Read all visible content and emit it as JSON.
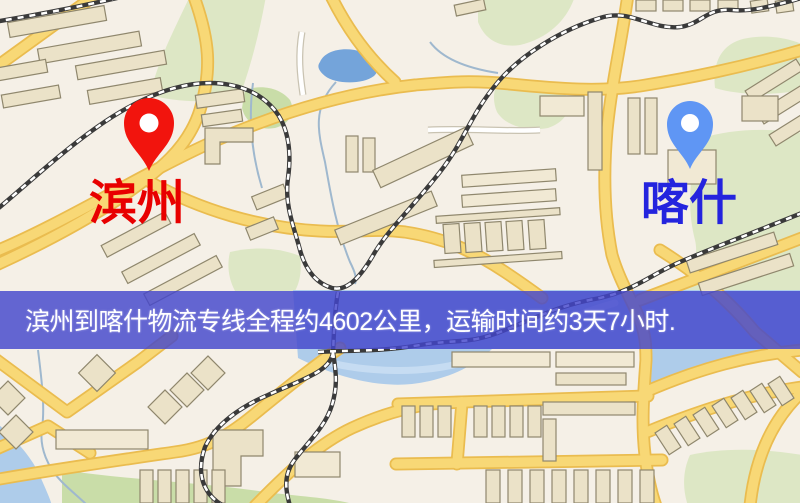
{
  "banner": {
    "text": "滨州到喀什物流专线全程约4602公里，运输时间约3天7小时.",
    "background_color": "#4345CC",
    "text_color": "#FFFFFF"
  },
  "route": {
    "origin": "滨州",
    "destination": "喀什",
    "distance": "约4602公里",
    "duration": "约3天7小时"
  },
  "markers": {
    "origin": {
      "label": "滨州",
      "pin_color": "#F2140D",
      "label_color": "#E80000"
    },
    "destination": {
      "label": "喀什",
      "pin_color": "#5F96F4",
      "label_color": "#2424DE"
    }
  },
  "map": {
    "colors": {
      "base": "#F5F0E7",
      "road_yellow": "#F8D876",
      "road_casing": "#EABC4F",
      "building_fill": "#EBE2C8",
      "building_stroke": "#8F876D",
      "park_green": "#DDE7C5",
      "park_green2": "#C9DDA8",
      "water_blue": "#74A4DA",
      "water_light": "#AECCEA",
      "railway": "#3A3A3A"
    }
  }
}
